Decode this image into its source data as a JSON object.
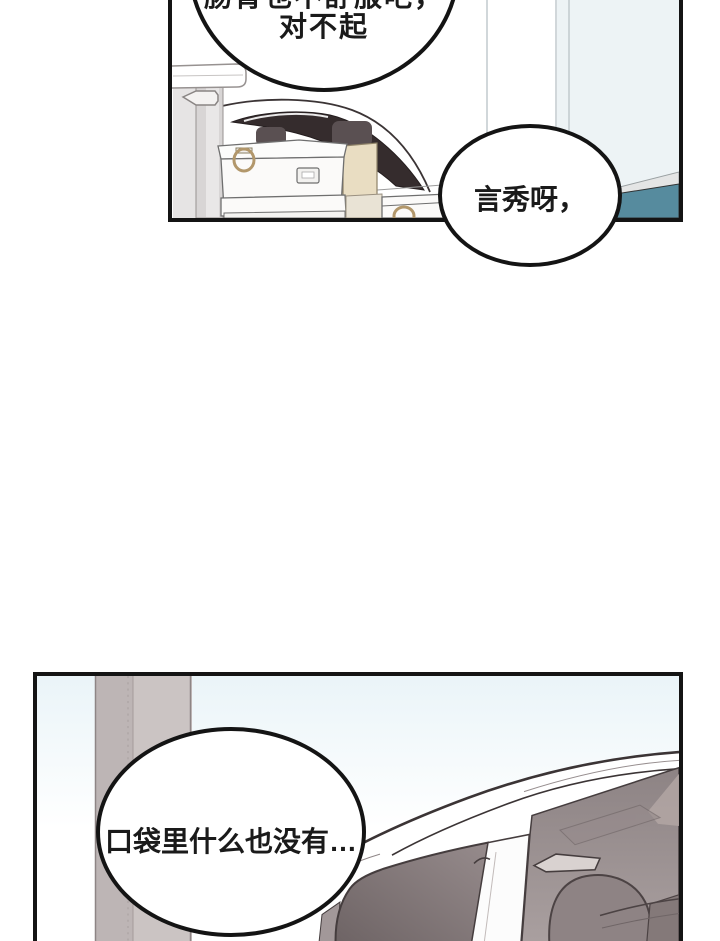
{
  "page": {
    "kind": "webtoon comic page",
    "panel_count": 2
  },
  "bubbles": {
    "apology": {
      "lines": [
        "肠胃也不舒服吧，",
        "对不起"
      ],
      "note_position": "top panel, clipped by top edge of image"
    },
    "calling": {
      "lines": [
        "言秀呀，"
      ],
      "note_position": "right side of top panel, overlapping panel bottom border"
    },
    "pocket": {
      "lines": [
        "口袋里什么也没有…"
      ],
      "note_position": "left side of bottom panel"
    }
  },
  "scenes": {
    "top": "white car with dark tinted window behind stacked white storage boxes with ring handles, tan cardboard box, garment-rack post and pale wall with teal baseboard strip",
    "bottom": "white SUV front quarter view with mauve windshield and dark side window, headrest and seats visible inside, gray garage pillar at left, pale blue sky"
  },
  "colors": {
    "panel_border": "#141414",
    "bubble_fill": "#ffffff",
    "text_color": "#1a1a1a",
    "teal_strip": "#568b9e",
    "gray_strip": "#e4e5e5",
    "wall_pale_blue": "#edf3f5",
    "dark_car_window": "#352c2d",
    "box_tan": "#e9ddc2",
    "box_tan_light": "#e9e3d5",
    "ring_handle_tan": "#b2976b",
    "sky_blue": "#eaf4f8",
    "pillar_gray": "#cbc4c3",
    "pillar_gray_dark": "#bdb5b5",
    "windshield_mauve_top": "#8d8384",
    "windshield_mauve_bottom": "#aba1a1",
    "side_window_dark": "#6c6263",
    "side_window_light": "#968b8c",
    "headrest_mauve": "#8e8384"
  }
}
